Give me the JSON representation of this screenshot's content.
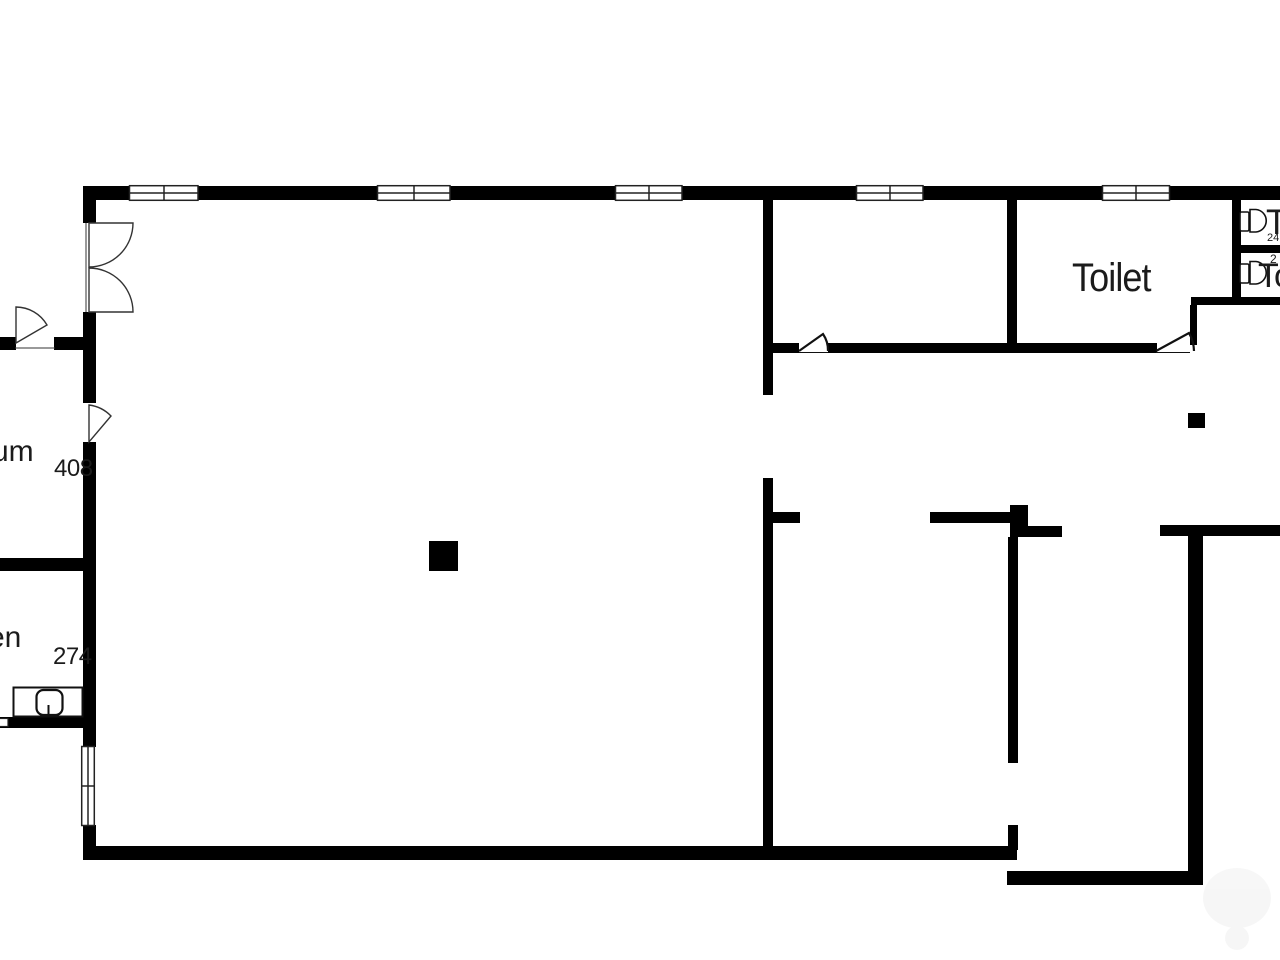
{
  "labels": {
    "room_left_upper": {
      "name_fragment": "um",
      "dimension": "408"
    },
    "room_left_lower": {
      "name_fragment": "en",
      "dimension": "274"
    },
    "toilet_room": {
      "name": "Toilet"
    },
    "stall_top": {
      "name_fragment": "T",
      "number_fragment": "24"
    },
    "stall_bottom": {
      "name_fragment": "To",
      "number_fragment": "2"
    }
  },
  "colors": {
    "walls": "#000000",
    "background": "#ffffff",
    "text": "#1b1b1b"
  }
}
